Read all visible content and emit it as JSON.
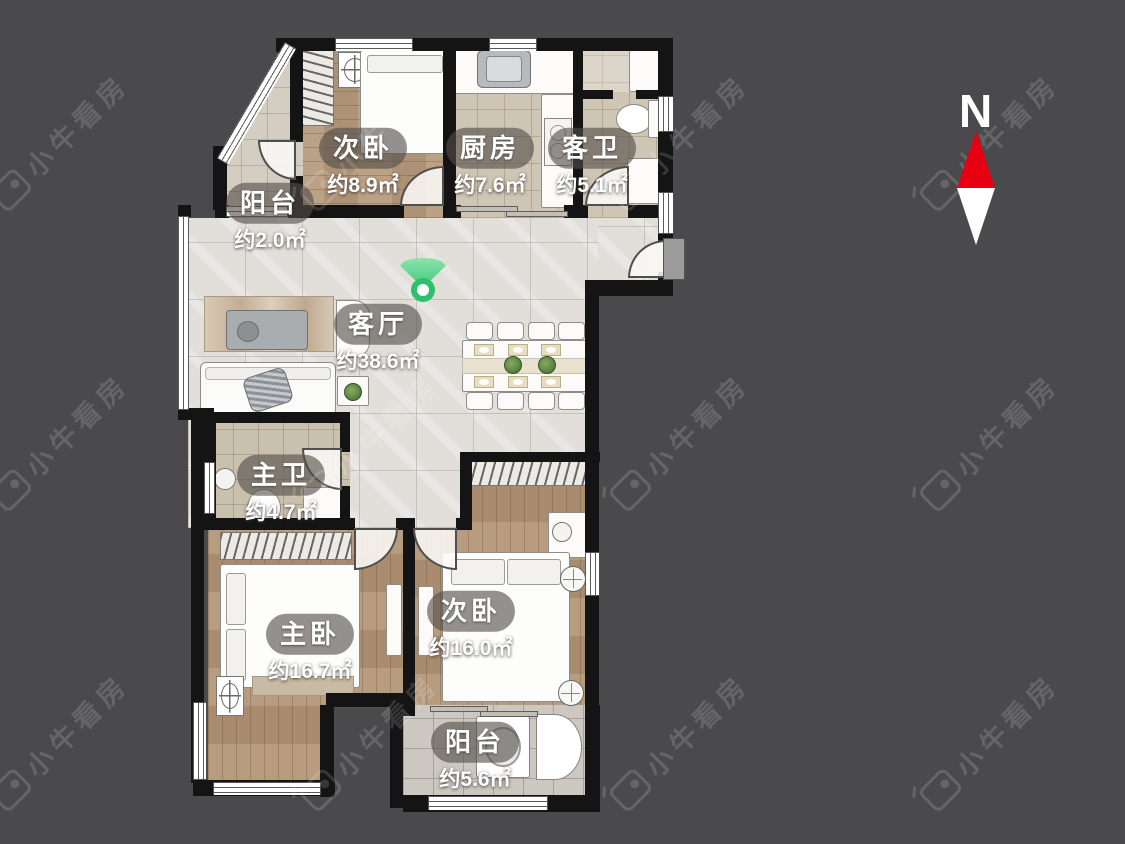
{
  "watermark": {
    "text": "小牛看房"
  },
  "compass": {
    "north_label": "N"
  },
  "rooms": [
    {
      "id": "bedroom-top",
      "name": "次卧",
      "area": "约8.9㎡"
    },
    {
      "id": "kitchen",
      "name": "厨房",
      "area": "约7.6㎡"
    },
    {
      "id": "guest-bath",
      "name": "客卫",
      "area": "约5.1㎡"
    },
    {
      "id": "balcony-top",
      "name": "阳台",
      "area": "约2.0㎡"
    },
    {
      "id": "living-room",
      "name": "客厅",
      "area": "约38.6㎡"
    },
    {
      "id": "master-bath",
      "name": "主卫",
      "area": "约4.7㎡"
    },
    {
      "id": "master-bedroom",
      "name": "主卧",
      "area": "约16.7㎡"
    },
    {
      "id": "bedroom-bottom",
      "name": "次卧",
      "area": "约16.0㎡"
    },
    {
      "id": "balcony-bottom",
      "name": "阳台",
      "area": "约5.6㎡"
    }
  ],
  "colors": {
    "background": "#4a4a4d",
    "wall": "#141414",
    "compass_north": "#e60012",
    "compass_south": "#ffffff",
    "viewpoint_green": "#2ec06e",
    "watermark_text": "rgba(255,255,255,0.15)"
  }
}
